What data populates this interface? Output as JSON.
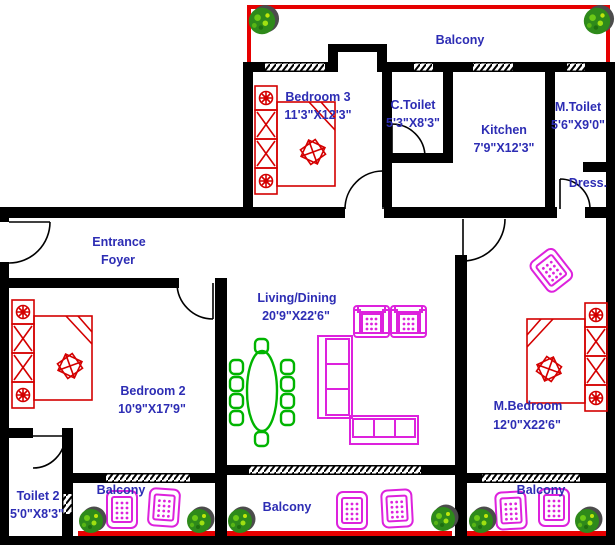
{
  "plan": {
    "title": "Apartment Floor Plan",
    "rooms": {
      "balcony_top": {
        "name": "Balcony"
      },
      "bedroom3": {
        "name": "Bedroom 3",
        "dims": "11'3\"X12'3\""
      },
      "c_toilet": {
        "name": "C.Toilet",
        "dims": "5'3\"X8'3\""
      },
      "kitchen": {
        "name": "Kitchen",
        "dims": "7'9\"X12'3\""
      },
      "m_toilet": {
        "name": "M.Toilet",
        "dims": "5'6\"X9'0\""
      },
      "dress": {
        "name": "Dress."
      },
      "entrance_foyer": {
        "line1": "Entrance",
        "line2": "Foyer"
      },
      "living_dining": {
        "name": "Living/Dining",
        "dims": "20'9\"X22'6\""
      },
      "bedroom2": {
        "name": "Bedroom 2",
        "dims": "10'9\"X17'9\""
      },
      "m_bedroom": {
        "name": "M.Bedroom",
        "dims": "12'0\"X22'6\""
      },
      "toilet2": {
        "name": "Toilet 2",
        "dims": "5'0\"X8'3\""
      },
      "balcony_bl": {
        "name": "Balcony"
      },
      "balcony_bm": {
        "name": "Balcony"
      },
      "balcony_br": {
        "name": "Balcony"
      }
    },
    "colors": {
      "wall": "#000000",
      "label_blue": "#2d2db4",
      "furniture_red": "#d40000",
      "railing_red": "#e60000",
      "furniture_magenta": "#dd22dd",
      "dining_green": "#00b400",
      "plant_green": "#2e8a1a",
      "background": "#ffffff"
    }
  }
}
